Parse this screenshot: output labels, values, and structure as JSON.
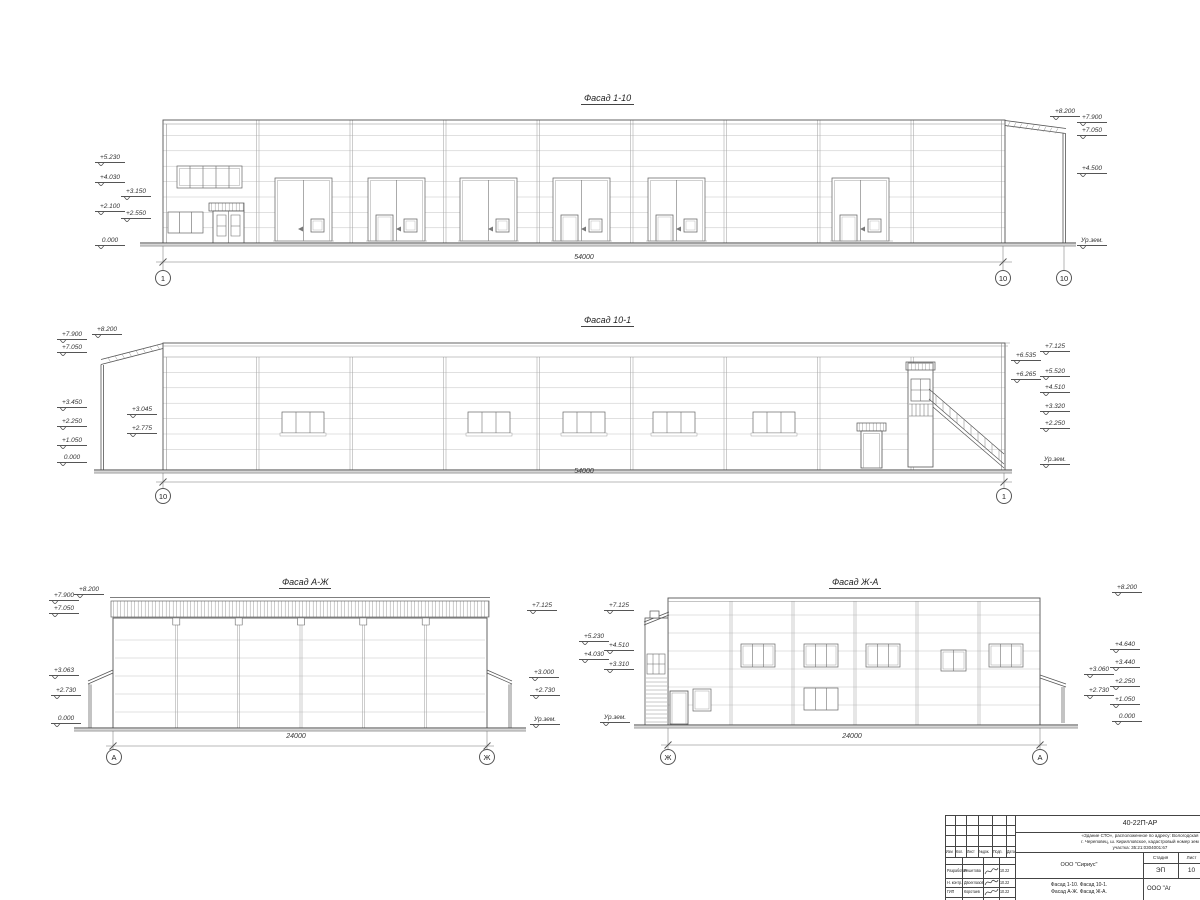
{
  "facades": {
    "f1_10": {
      "title": "Фасад 1-10",
      "dim": "54000",
      "axes": [
        "1",
        "10",
        "10"
      ],
      "marks_left": [
        "+5.230",
        "+4.030",
        "+3.150",
        "+2.100",
        "+2.550",
        "0.000"
      ],
      "marks_right": [
        "+8.200",
        "+7.900",
        "+7.050",
        "+4.500",
        "Ур.зем."
      ]
    },
    "f10_1": {
      "title": "Фасад 10-1",
      "dim": "54000",
      "axes": [
        "10",
        "1"
      ],
      "marks_left": [
        "+8.200",
        "+7.900",
        "+7.050",
        "+3.450",
        "+3.045",
        "+2.250",
        "+2.775",
        "+1.050",
        "0.000"
      ],
      "marks_right": [
        "+7.125",
        "+6.535",
        "+5.520",
        "+6.265",
        "+4.510",
        "+3.320",
        "+2.250",
        "Ур.зем."
      ]
    },
    "fa_zh": {
      "title": "Фасад А-Ж",
      "dim": "24000",
      "axes": [
        "А",
        "Ж"
      ],
      "marks_left": [
        "+8.200",
        "+7.900",
        "+7.050",
        "+3.063",
        "+2.730",
        "0.000"
      ],
      "marks_right": [
        "+7.125",
        "+3.000",
        "+2.730",
        "Ур.зем."
      ]
    },
    "fzh_a": {
      "title": "Фасад Ж-А",
      "dim": "24000",
      "axes": [
        "Ж",
        "А"
      ],
      "marks_left": [
        "+7.125",
        "+5.230",
        "+4.510",
        "+4.030",
        "+3.310",
        "Ур.зем."
      ],
      "marks_right": [
        "+8.200",
        "+4.640",
        "+3.440",
        "+3.060",
        "+2.250",
        "+2.730",
        "+1.050",
        "0.000"
      ]
    }
  },
  "titleblock": {
    "doc_number": "40-22П-АР",
    "project_lines": [
      "«Здание СТО», расположенное по адресу: Вологодская",
      "г. Череповец, ш. Кирилловское, кадастровый номер зем",
      "участка: 35:21:0304001:67"
    ],
    "header_cols": [
      "Изм",
      "Кол.",
      "Лист",
      "№док.",
      "Подп.",
      "Дата"
    ],
    "rows": [
      {
        "role": "Разработал",
        "name": "Решетова",
        "date": "10.22"
      },
      {
        "role": "Н. контр.",
        "name": "Двоеглазов",
        "date": "10.22"
      },
      {
        "role": "ГИП",
        "name": "Коротаев",
        "date": "10.22"
      }
    ],
    "org": "ООО \"Сириус\"",
    "stage_label": "Стадия",
    "sheet_label": "Лист",
    "stage": "ЭП",
    "sheet": "10",
    "sheet_title_lines": [
      "Фасад 1-10. Фасад 10-1.",
      "Фасад А-Ж. Фасад Ж-А."
    ],
    "org2": "ООО \"Аг"
  }
}
